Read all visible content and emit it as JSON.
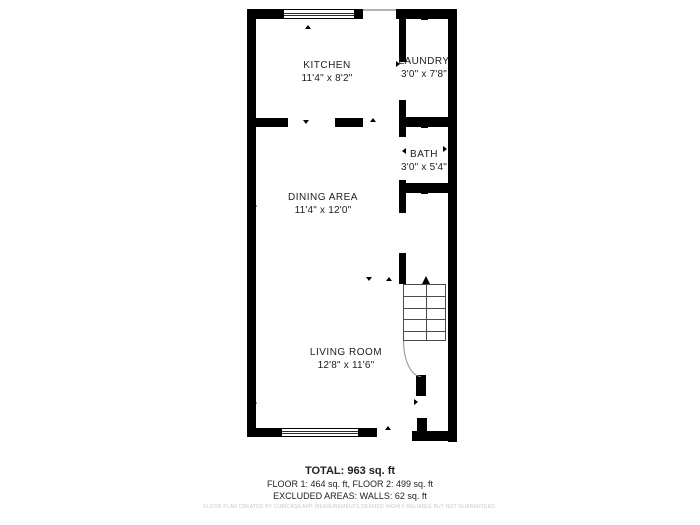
{
  "rooms": [
    {
      "id": "kitchen",
      "name": "KITCHEN",
      "dims": "11'4\" x 8'2\""
    },
    {
      "id": "laundry",
      "name": "LAUNDRY",
      "dims": "3'0\" x 7'8\""
    },
    {
      "id": "bath",
      "name": "BATH",
      "dims": "3'0\" x 5'4\""
    },
    {
      "id": "dining",
      "name": "DINING AREA",
      "dims": "11'4\" x 12'0\""
    },
    {
      "id": "living",
      "name": "LIVING ROOM",
      "dims": "12'8\" x 11'6\""
    }
  ],
  "summary": {
    "total": "TOTAL: 963 sq. ft",
    "floors": "FLOOR 1: 464 sq. ft, FLOOR 2: 499 sq. ft",
    "excluded": "EXCLUDED AREAS: WALLS: 62 sq. ft"
  },
  "disclaimer": "FLOOR PLAN CREATED BY CUBICASA APP. MEASUREMENTS DEEMED HIGHLY RELIABLE BUT NOT GUARANTEED.",
  "colors": {
    "wall": "#000000",
    "text": "#1d1d1d",
    "disclaimer": "#c8c8c8"
  }
}
